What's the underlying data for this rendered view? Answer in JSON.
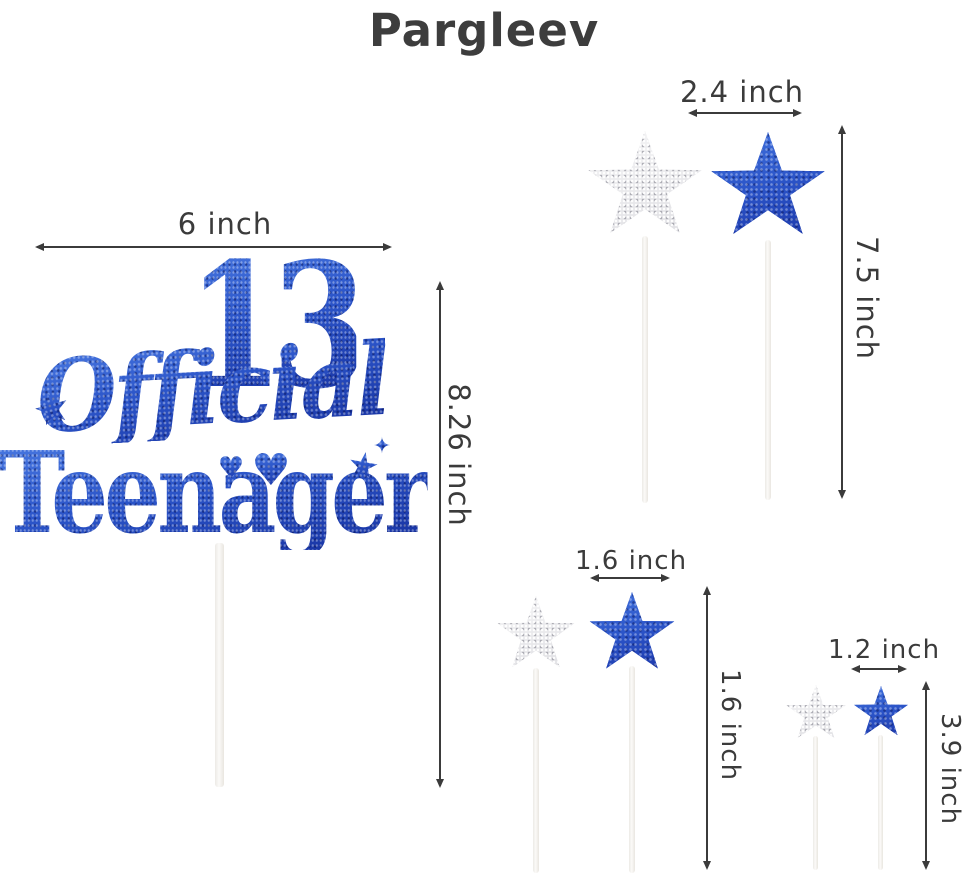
{
  "brand": "Pargleev",
  "topper": {
    "number": "13",
    "word_official": "Official",
    "word_teenager": "Teenager",
    "decor": {
      "star": "★",
      "sparkle": "✦",
      "heart": "♥"
    }
  },
  "annotations": {
    "topper_width": "6 inch",
    "topper_height": "8.26 inch",
    "large_star_width": "2.4 inch",
    "large_star_height": "7.5 inch",
    "medium_star_width": "1.6 inch",
    "medium_star_height": "1.6 inch",
    "small_star_width": "1.2 inch",
    "small_star_height": "3.9 inch"
  },
  "colors": {
    "blue_glitter": "#2b54c8",
    "silver_glitter": "#eaeaec",
    "dimension_line": "#3b3b3b",
    "brand_text": "#3d3d3d",
    "stick": "#f4f2ee",
    "background": "#ffffff"
  }
}
